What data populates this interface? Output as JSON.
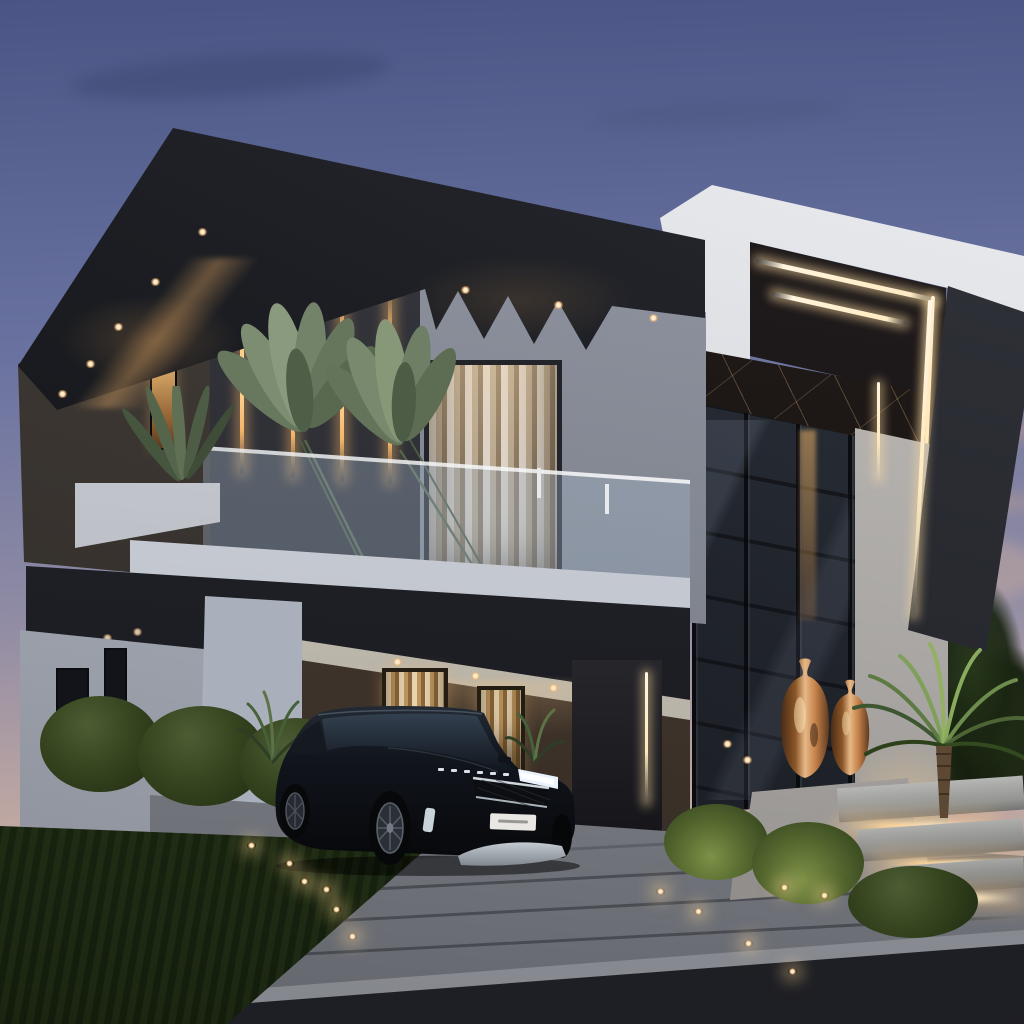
{
  "scene": {
    "title": "Modern two-storey villa exterior at dusk with black SUV in driveway",
    "time_of_day": "dusk",
    "style": "contemporary architecture 3D rendering"
  },
  "palette": {
    "sky-top": "#4a5585",
    "sky-mid": "#6a73a0",
    "sky-low": "#8f8ba4",
    "sky-horizon": "#c0a8a2",
    "charcoal": "#1b1d22",
    "wall-grey": "#8f95a0",
    "white-volume": "#e8e9ec",
    "amber": "#f5b56a",
    "led-white": "#ffeccb",
    "bronze": "#c98e54",
    "foliage": "#49603a",
    "paver": "#8f9299",
    "asphalt": "#232428"
  },
  "objects": {
    "building": [
      "dark charcoal roof fascia with recessed downlights",
      "sawtooth concrete corbels",
      "upper floor wall with vertical amber LED strips",
      "glass balcony railing with white planters and large leaf plants",
      "white cantilevered entrance volume with linear LED coves",
      "black marble feature panel",
      "double-height glazed entrance with dark mullions",
      "white ground-floor walls",
      "white fluted pillars",
      "carport with warm-lit curtained windows"
    ],
    "vehicle": "black luxury compact SUV with lit headlights and white licence plate",
    "landscape": [
      "manicured lawn",
      "clipped hedges",
      "cycad palm",
      "bronze decorative vases on white plinth",
      "floating concrete steps with under-tread lighting",
      "paver driveway with ground lights",
      "asphalt street with concrete curb"
    ]
  }
}
